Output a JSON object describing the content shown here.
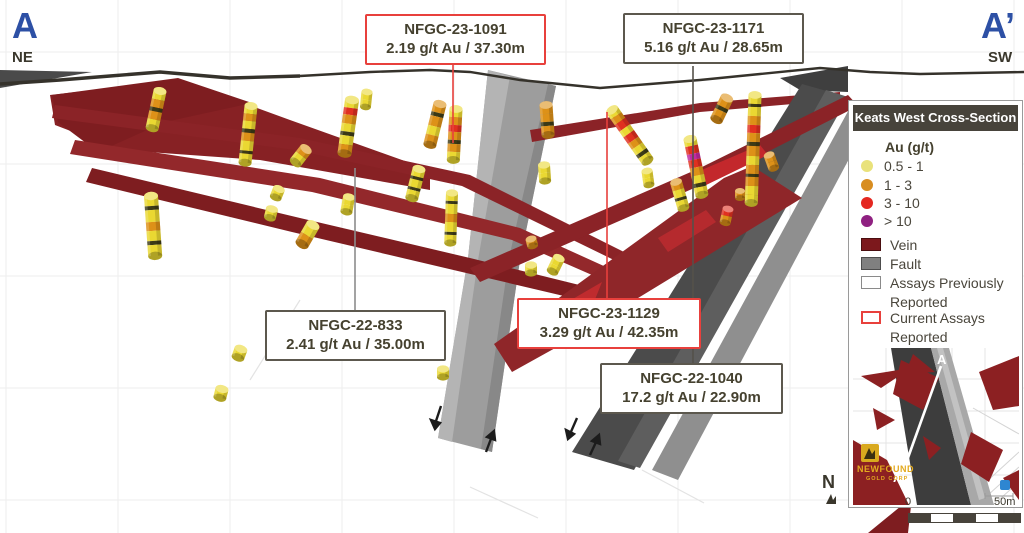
{
  "section_labels": {
    "left_letter": "A",
    "left_dir": "NE",
    "right_letter": "A’",
    "right_dir": "SW"
  },
  "callouts": [
    {
      "id": "NFGC-23-1091",
      "assay": "2.19 g/t Au / 37.30m",
      "status": "current"
    },
    {
      "id": "NFGC-23-1171",
      "assay": "5.16 g/t Au / 28.65m",
      "status": "previous"
    },
    {
      "id": "NFGC-22-833",
      "assay": "2.41 g/t Au / 35.00m",
      "status": "previous"
    },
    {
      "id": "NFGC-23-1129",
      "assay": "3.29 g/t Au / 42.35m",
      "status": "current"
    },
    {
      "id": "NFGC-22-1040",
      "assay": "17.2 g/t Au / 22.90m",
      "status": "previous"
    }
  ],
  "legend": {
    "title": "Keats West Cross-Section",
    "au_title": "Au (g/t)",
    "au_classes": [
      {
        "label": "0.5 - 1",
        "color": "#e9e27b"
      },
      {
        "label": "1 - 3",
        "color": "#d88d20"
      },
      {
        "label": "3 - 10",
        "color": "#e42720"
      },
      {
        "label": "> 10",
        "color": "#8f2181"
      }
    ],
    "items": [
      {
        "label": "Vein",
        "color": "#7c181c"
      },
      {
        "label": "Fault",
        "color": "#808080"
      },
      {
        "label": "Assays Previously Reported",
        "swatch": "outline-gray"
      },
      {
        "label": "Current Assays Reported",
        "swatch": "outline-red"
      }
    ]
  },
  "inset": {
    "a": "A",
    "a_prime": "A’",
    "logo_line1": "NEWFOUND",
    "logo_line2": "GOLD CORP"
  },
  "scale_bar": {
    "start": "0",
    "end": "50m"
  },
  "north_label": "N",
  "colors": {
    "section_letter_blue": "#2d50a5",
    "callout_current_border": "#e8403c",
    "callout_previous_border": "#5c584e",
    "vein": "#8b2327",
    "fault_light": "#9d9d9d",
    "fault_dark": "#4b4b4b",
    "legend_header_bg": "#47433b"
  },
  "scene": {
    "drill_stacks": [
      {
        "x": 160,
        "y": 91,
        "a": 12,
        "w": 13,
        "b": [
          [
            "#ead832",
            9
          ],
          [
            "#dd9118",
            8
          ],
          [
            "#3c3a16",
            4
          ],
          [
            "#dd9118",
            8
          ],
          [
            "#ead832",
            9
          ]
        ]
      },
      {
        "x": 151,
        "y": 196,
        "a": -4,
        "w": 14,
        "b": [
          [
            "#ead832",
            10
          ],
          [
            "#3c3a16",
            4
          ],
          [
            "#ead832",
            12
          ],
          [
            "#dd9118",
            9
          ],
          [
            "#ead832",
            10
          ],
          [
            "#3c3a16",
            4
          ],
          [
            "#ead832",
            11
          ]
        ]
      },
      {
        "x": 251,
        "y": 106,
        "a": 6,
        "w": 13,
        "b": [
          [
            "#ead832",
            8
          ],
          [
            "#dd9118",
            7
          ],
          [
            "#ead832",
            8
          ],
          [
            "#3c3a16",
            4
          ],
          [
            "#dd9118",
            8
          ],
          [
            "#ead832",
            10
          ],
          [
            "#3c3a16",
            3
          ],
          [
            "#ead832",
            9
          ]
        ]
      },
      {
        "x": 306,
        "y": 149,
        "a": 38,
        "w": 13,
        "b": [
          [
            "#dd9118",
            8
          ],
          [
            "#ead832",
            9
          ]
        ]
      },
      {
        "x": 313,
        "y": 225,
        "a": 30,
        "w": 14,
        "b": [
          [
            "#ead832",
            12
          ],
          [
            "#dd9118",
            10
          ]
        ]
      },
      {
        "x": 352,
        "y": 100,
        "a": 8,
        "w": 14,
        "b": [
          [
            "#ead832",
            8
          ],
          [
            "#e03020",
            7
          ],
          [
            "#dd9118",
            9
          ],
          [
            "#ead832",
            8
          ],
          [
            "#3c3a16",
            4
          ],
          [
            "#ead832",
            9
          ],
          [
            "#dd9118",
            9
          ]
        ]
      },
      {
        "x": 440,
        "y": 104,
        "a": 14,
        "w": 13,
        "b": [
          [
            "#dd9118",
            9
          ],
          [
            "#3c3a16",
            4
          ],
          [
            "#dd9118",
            10
          ],
          [
            "#ead832",
            9
          ],
          [
            "#dd9118",
            10
          ]
        ]
      },
      {
        "x": 456,
        "y": 109,
        "a": 3,
        "w": 13,
        "b": [
          [
            "#ead832",
            8
          ],
          [
            "#dd9118",
            8
          ],
          [
            "#e03020",
            7
          ],
          [
            "#dd9118",
            8
          ],
          [
            "#3c3a16",
            4
          ],
          [
            "#dd9118",
            8
          ],
          [
            "#ead832",
            8
          ]
        ]
      },
      {
        "x": 452,
        "y": 193,
        "a": 2,
        "w": 12,
        "b": [
          [
            "#ead832",
            8
          ],
          [
            "#3c3a16",
            3
          ],
          [
            "#ead832",
            10
          ],
          [
            "#dd9118",
            8
          ],
          [
            "#ead832",
            10
          ],
          [
            "#3c3a16",
            3
          ],
          [
            "#ead832",
            8
          ]
        ]
      },
      {
        "x": 419,
        "y": 169,
        "a": 14,
        "w": 13,
        "b": [
          [
            "#ead832",
            8
          ],
          [
            "#3c3a16",
            3
          ],
          [
            "#ead832",
            8
          ],
          [
            "#3c3a16",
            3
          ],
          [
            "#ead832",
            8
          ]
        ]
      },
      {
        "x": 546,
        "y": 105,
        "a": -4,
        "w": 13,
        "b": [
          [
            "#dd9118",
            9
          ],
          [
            "#dd9118",
            8
          ],
          [
            "#3c3a16",
            4
          ],
          [
            "#dd9118",
            9
          ]
        ]
      },
      {
        "x": 544,
        "y": 165,
        "a": -4,
        "w": 12,
        "b": [
          [
            "#ead832",
            8
          ],
          [
            "#ead832",
            8
          ]
        ]
      },
      {
        "x": 612,
        "y": 110,
        "a": -35,
        "w": 13,
        "b": [
          [
            "#ead832",
            7
          ],
          [
            "#dd9118",
            7
          ],
          [
            "#e03020",
            8
          ],
          [
            "#ead832",
            7
          ],
          [
            "#e03020",
            8
          ],
          [
            "#dd9118",
            7
          ],
          [
            "#ead832",
            7
          ],
          [
            "#3c3a16",
            4
          ],
          [
            "#ead832",
            7
          ]
        ]
      },
      {
        "x": 690,
        "y": 139,
        "a": -12,
        "w": 13,
        "b": [
          [
            "#ead832",
            7
          ],
          [
            "#e03020",
            8
          ],
          [
            "#c12aa0",
            6
          ],
          [
            "#e03020",
            8
          ],
          [
            "#dd9118",
            8
          ],
          [
            "#ead832",
            8
          ],
          [
            "#3c3a16",
            4
          ],
          [
            "#ead832",
            8
          ]
        ]
      },
      {
        "x": 676,
        "y": 182,
        "a": -16,
        "w": 12,
        "b": [
          [
            "#dd9118",
            8
          ],
          [
            "#ead832",
            8
          ],
          [
            "#3c3a16",
            3
          ],
          [
            "#ead832",
            8
          ]
        ]
      },
      {
        "x": 647,
        "y": 171,
        "a": -8,
        "w": 11,
        "b": [
          [
            "#ead832",
            7
          ],
          [
            "#ead832",
            7
          ]
        ]
      },
      {
        "x": 755,
        "y": 95,
        "a": 2,
        "w": 13,
        "b": [
          [
            "#ead832",
            9
          ],
          [
            "#3c3a16",
            3
          ],
          [
            "#ead832",
            9
          ],
          [
            "#dd9118",
            9
          ],
          [
            "#e03020",
            8
          ],
          [
            "#dd9118",
            9
          ],
          [
            "#3c3a16",
            4
          ],
          [
            "#dd9118",
            10
          ],
          [
            "#ead832",
            9
          ],
          [
            "#dd9118",
            9
          ],
          [
            "#3c3a16",
            3
          ],
          [
            "#dd9118",
            9
          ],
          [
            "#ead832",
            9
          ],
          [
            "#ead832",
            8
          ]
        ]
      },
      {
        "x": 727,
        "y": 98,
        "a": 26,
        "w": 13,
        "b": [
          [
            "#dd9118",
            10
          ],
          [
            "#3c3a16",
            4
          ],
          [
            "#dd9118",
            10
          ]
        ]
      },
      {
        "x": 769,
        "y": 155,
        "a": -20,
        "w": 11,
        "b": [
          [
            "#dd9118",
            7
          ],
          [
            "#dd9118",
            7
          ]
        ]
      },
      {
        "x": 740,
        "y": 191,
        "a": 0,
        "w": 10,
        "b": [
          [
            "#dd9118",
            7
          ]
        ]
      },
      {
        "x": 728,
        "y": 209,
        "a": 12,
        "w": 11,
        "b": [
          [
            "#e03020",
            7
          ],
          [
            "#dd9118",
            7
          ]
        ]
      },
      {
        "x": 531,
        "y": 239,
        "a": -14,
        "w": 11,
        "b": [
          [
            "#dd9118",
            7
          ]
        ]
      },
      {
        "x": 559,
        "y": 258,
        "a": 26,
        "w": 12,
        "b": [
          [
            "#ead832",
            8
          ],
          [
            "#ead832",
            7
          ]
        ]
      },
      {
        "x": 531,
        "y": 265,
        "a": 0,
        "w": 12,
        "b": [
          [
            "#ead832",
            8
          ]
        ]
      },
      {
        "x": 349,
        "y": 197,
        "a": 10,
        "w": 12,
        "b": [
          [
            "#ead832",
            8
          ],
          [
            "#ead832",
            7
          ]
        ]
      },
      {
        "x": 279,
        "y": 189,
        "a": 22,
        "w": 12,
        "b": [
          [
            "#ead832",
            9
          ]
        ]
      },
      {
        "x": 272,
        "y": 209,
        "a": 14,
        "w": 12,
        "b": [
          [
            "#ead832",
            9
          ]
        ]
      },
      {
        "x": 241,
        "y": 349,
        "a": 20,
        "w": 13,
        "b": [
          [
            "#ead832",
            9
          ]
        ]
      },
      {
        "x": 222,
        "y": 389,
        "a": 14,
        "w": 13,
        "b": [
          [
            "#ead832",
            9
          ]
        ]
      },
      {
        "x": 443,
        "y": 369,
        "a": 0,
        "w": 12,
        "b": [
          [
            "#ead832",
            8
          ]
        ]
      },
      {
        "x": 367,
        "y": 92,
        "a": 6,
        "w": 11,
        "b": [
          [
            "#ead832",
            8
          ],
          [
            "#ead832",
            7
          ]
        ]
      }
    ]
  }
}
